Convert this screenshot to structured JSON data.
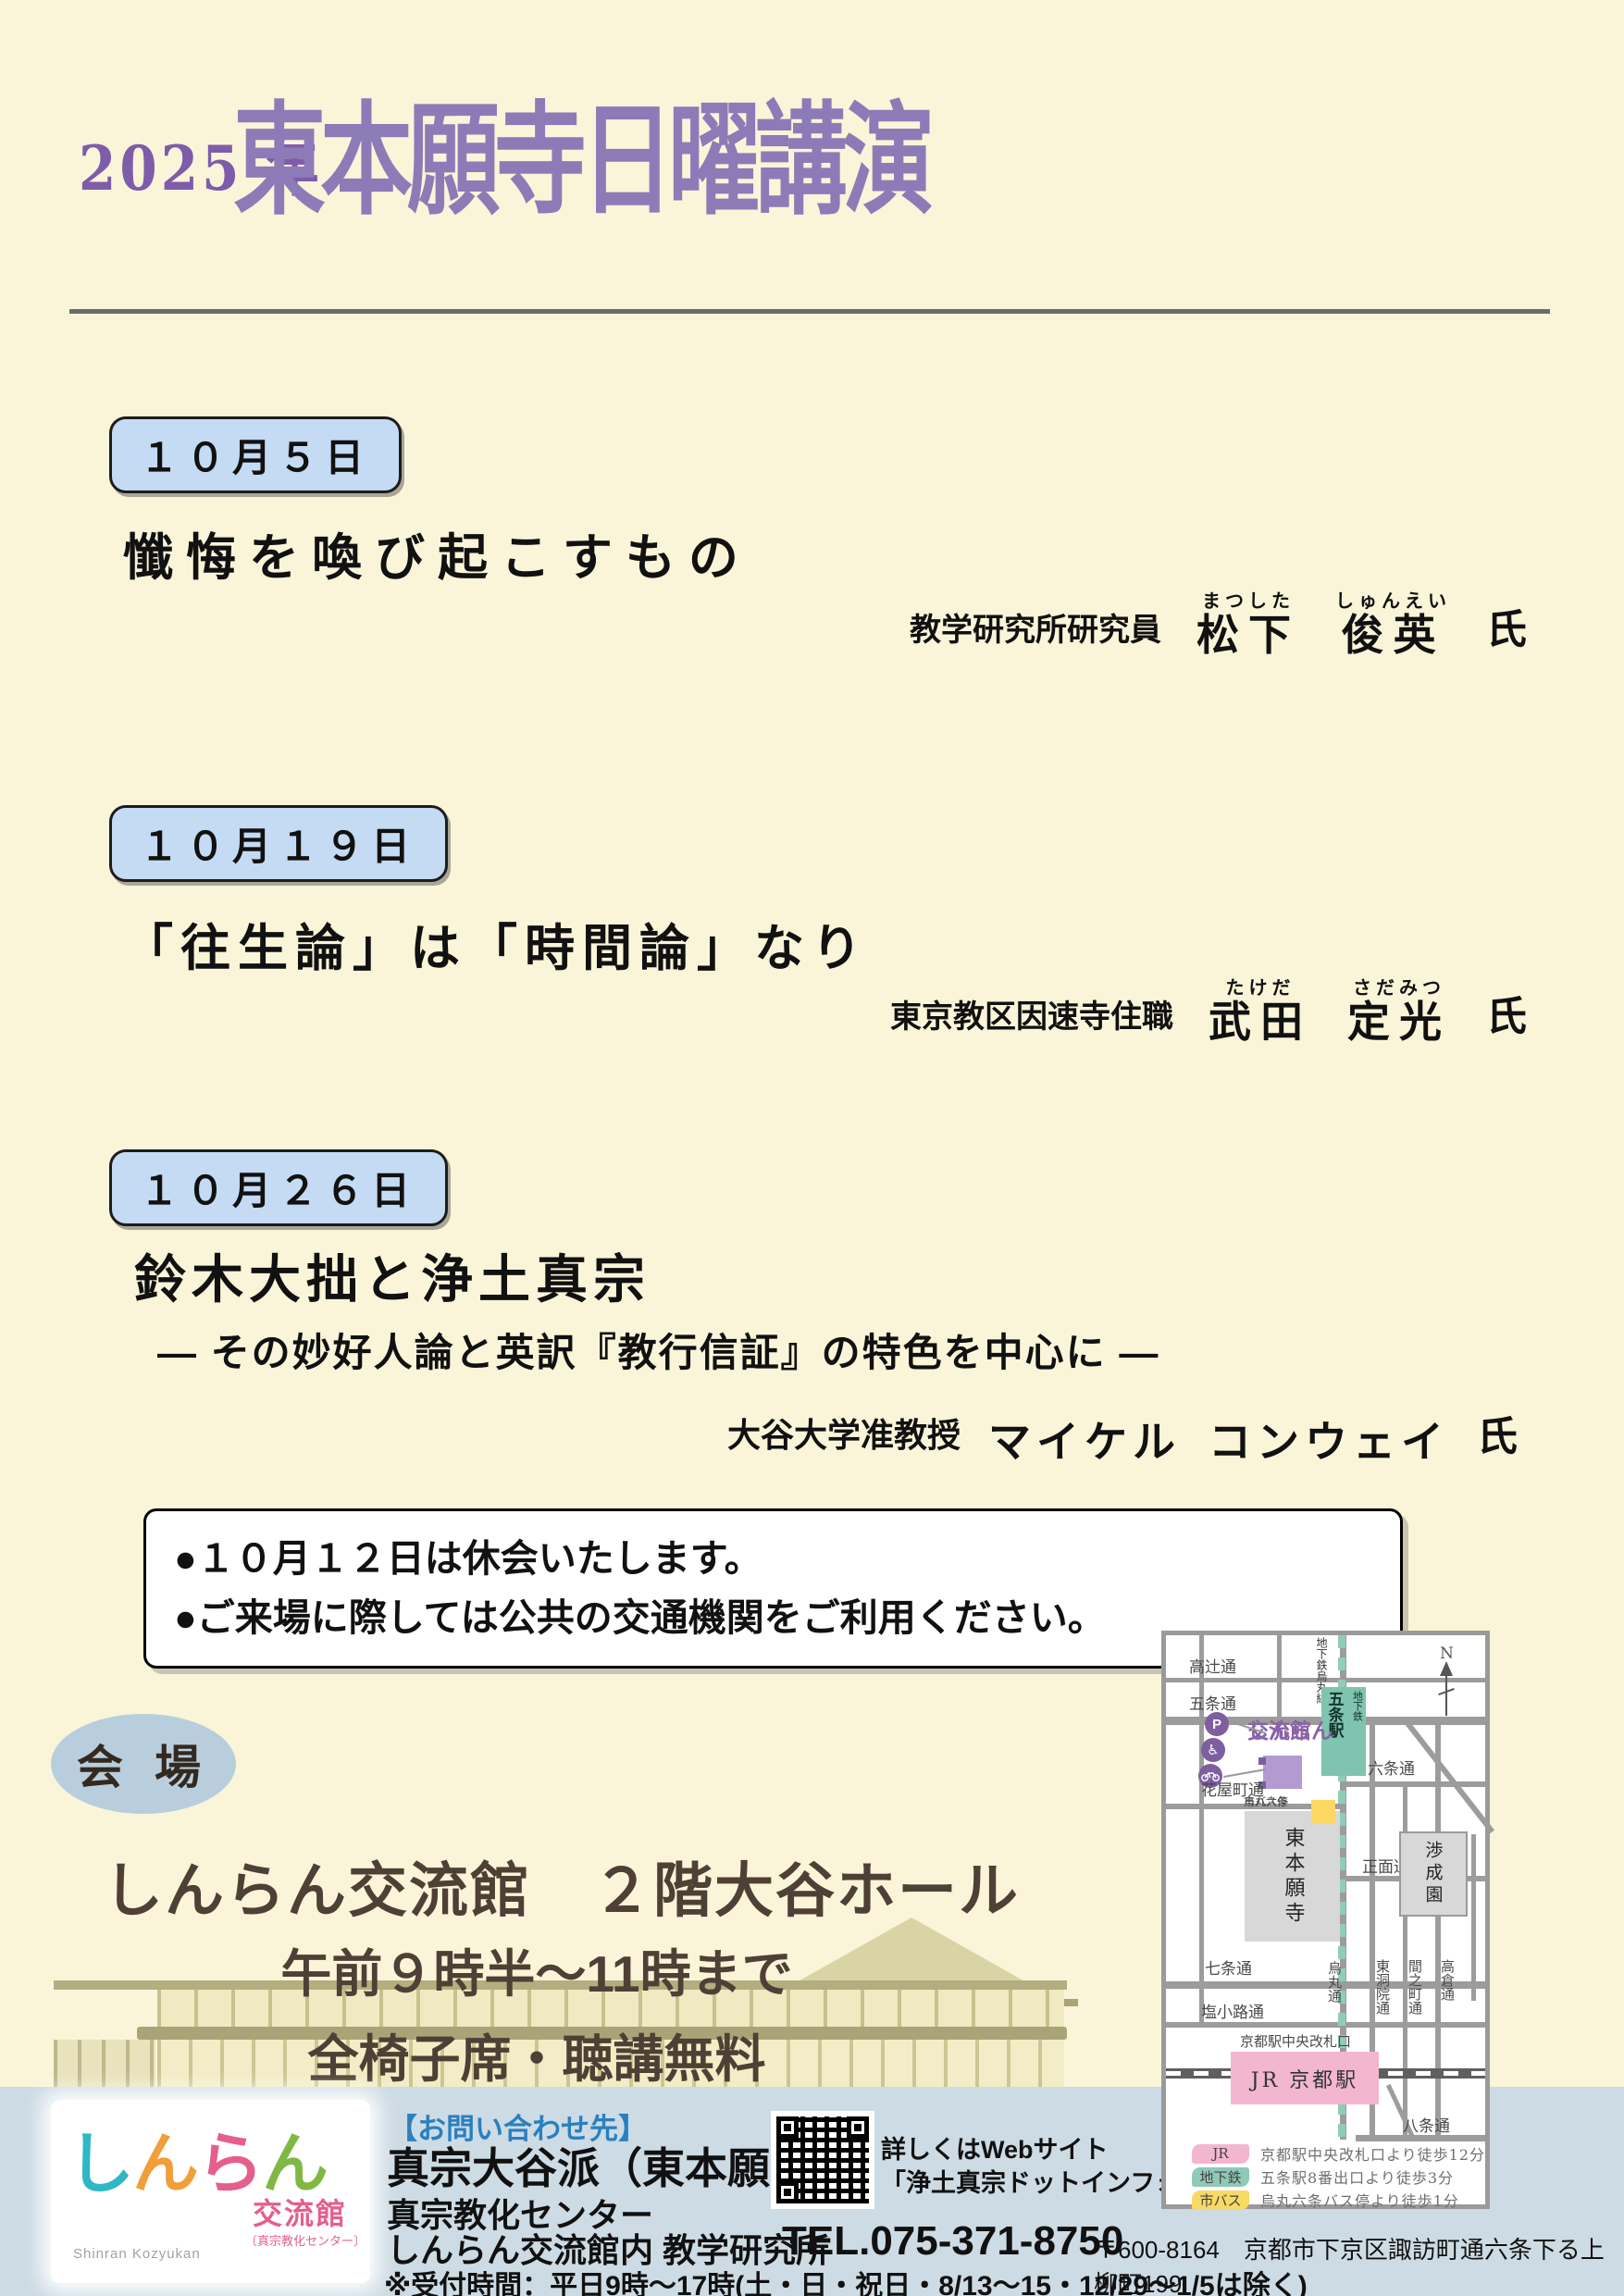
{
  "colors": {
    "background": "#faf5d9",
    "title_purple": "#8d7bb8",
    "badge_blue": "#c5daf3",
    "footer_blue": "#cddbe4",
    "venue_brown": "#4e4034",
    "oval_blue": "#b9cedd",
    "map_purple": "#8a63a8",
    "map_teal": "#7fc4ae",
    "map_pink": "#f3b6cf",
    "map_yellow": "#fdd863",
    "contact_blue": "#2980c0"
  },
  "header": {
    "year": "2025 年",
    "title": "東本願寺日曜講演"
  },
  "lectures": [
    {
      "date": "１０月５日",
      "title": "懺悔を喚び起こすもの",
      "affiliation": "教学研究所研究員",
      "name1": {
        "kanji": "松下",
        "furigana": "まつした"
      },
      "name2": {
        "kanji": "俊英",
        "furigana": "しゅんえい"
      },
      "honorific": "氏"
    },
    {
      "date": "１０月１９日",
      "title": "「往生論」は「時間論」なり",
      "affiliation": "東京教区因速寺住職",
      "name1": {
        "kanji": "武田",
        "furigana": "たけだ"
      },
      "name2": {
        "kanji": "定光",
        "furigana": "さだみつ"
      },
      "honorific": "氏"
    },
    {
      "date": "１０月２６日",
      "title": "鈴木大拙と浄土真宗",
      "subtitle": "― その妙好人論と英訳『教行信証』の特色を中心に ―",
      "affiliation": "大谷大学准教授",
      "name1": {
        "kanji": "マイケル",
        "furigana": ""
      },
      "name2": {
        "kanji": "コンウェイ",
        "furigana": ""
      },
      "honorific": "氏"
    }
  ],
  "notice": [
    "●１０月１２日は休会いたします。",
    "●ご来場に際しては公共の交通機関をご利用ください。"
  ],
  "venue": {
    "label": "会 場",
    "name": "しんらん交流館　２階大谷ホール",
    "time": "午前９時半～11時まで",
    "seating": "全椅子席・聴講無料"
  },
  "map": {
    "compass": "N",
    "subway_line": "地下鉄烏丸線",
    "station_name": "五条駅",
    "station_type": "地下鉄",
    "shinran_line1": "しんらん",
    "shinran_line2": "交流館",
    "streets": {
      "takatsuji": "高辻通",
      "gojo": "五条通",
      "rokujo": "六条通",
      "hanayacho": "花屋町通",
      "shomen": "正面通",
      "shichijo": "七条通",
      "shiokoji": "塩小路通",
      "hachijo": "八条通",
      "karasuma": "烏丸通",
      "higashinotoin": "東洞院通",
      "ainomachi": "間之町通",
      "takakura": "高倉通"
    },
    "bus_stop_line1": "市バス停",
    "bus_stop_line2": "烏丸六条",
    "honganji": "東本願寺",
    "shoseien": "渉成園",
    "kyoto_gate": "京都駅中央改札口",
    "jr_station": "JR 京都駅",
    "icons": {
      "parking": "P",
      "wheelchair": "♿"
    },
    "legend": [
      {
        "chip": "JR",
        "text": "京都駅中央改札口より徒歩12分"
      },
      {
        "chip": "地下鉄",
        "text": "五条駅8番出口より徒歩3分"
      },
      {
        "chip": "市バス",
        "text": "烏丸六条バス停より徒歩1分"
      }
    ]
  },
  "footer": {
    "logo": {
      "char0": "し",
      "char1": "ん",
      "char2": "ら",
      "char3": "ん",
      "kokan": "交流館",
      "sub": "〔真宗教化センター〕",
      "romaji": "Shinran Kozyukan"
    },
    "contact_heading": "【お問い合わせ先】",
    "org1": "真宗大谷派（東本願寺）",
    "org2": "真宗教化センター",
    "org3": "しんらん交流館内 教学研究所",
    "tel": "TEL.075-371-8750",
    "address": "〒600-8164　京都市下京区諏訪町通六条下る上柳町199",
    "hours": "※受付時間：平日9時～17時(土・日・祝日・8/13～15・12/29～1/5は除く)",
    "web1": "詳しくはWebサイト",
    "web2": "「浄土真宗ドットインフォ」まで"
  }
}
